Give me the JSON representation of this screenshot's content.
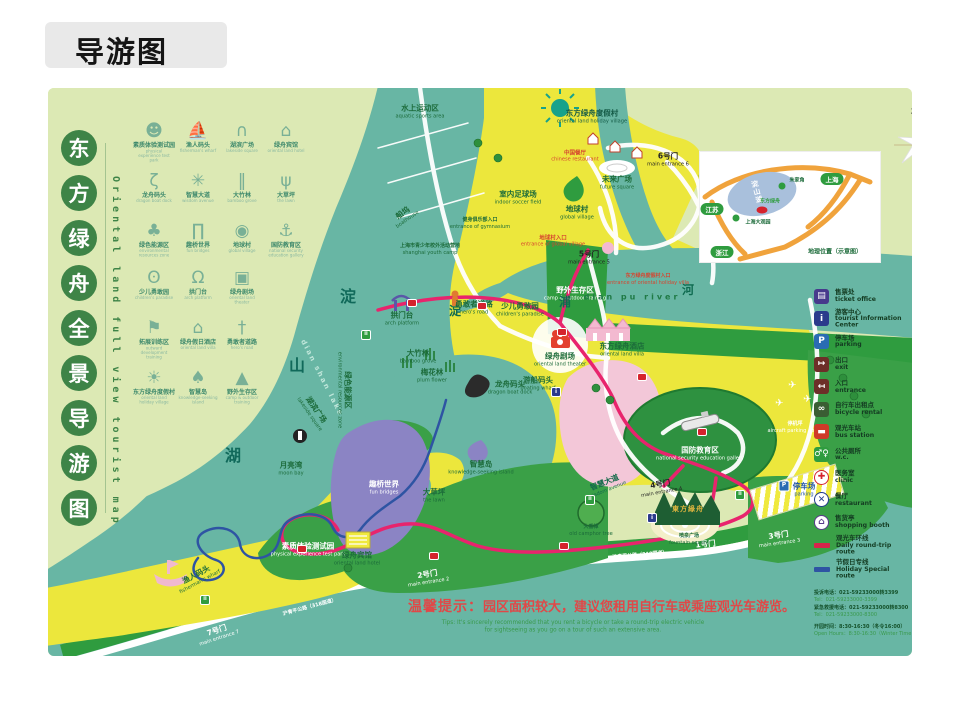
{
  "title": "导游图",
  "panel": {
    "chars": [
      "东",
      "方",
      "绿",
      "舟",
      "全",
      "景",
      "导",
      "游",
      "图"
    ],
    "vertical_en": "Oriental land full view tourist map"
  },
  "attractions_a": [
    {
      "zh": "素质体验测试园",
      "en": "physical experience test park",
      "glyph": "☻"
    },
    {
      "zh": "渔人码头",
      "en": "fisherman's wharf",
      "glyph": "⛵"
    },
    {
      "zh": "湖滨广场",
      "en": "lakeside square",
      "glyph": "∩"
    },
    {
      "zh": "绿舟宾馆",
      "en": "oriental land hotel",
      "glyph": "⌂"
    },
    {
      "zh": "龙舟码头",
      "en": "dragon boat dock",
      "glyph": "ζ"
    },
    {
      "zh": "智慧大道",
      "en": "wisdom avenue",
      "glyph": "✳"
    },
    {
      "zh": "大竹林",
      "en": "bamboo grove",
      "glyph": "‖"
    },
    {
      "zh": "大草坪",
      "en": "the lawn",
      "glyph": "ψ"
    },
    {
      "zh": "绿色能源区",
      "en": "environmental resources zone",
      "glyph": "♣"
    },
    {
      "zh": "趣桥世界",
      "en": "fun bridges",
      "glyph": "∏"
    },
    {
      "zh": "地球村",
      "en": "global village",
      "glyph": "◉"
    },
    {
      "zh": "国防教育区",
      "en": "national security education gallery",
      "glyph": "⚓"
    }
  ],
  "attractions_b": [
    {
      "zh": "少儿勇敢园",
      "en": "children's paradise",
      "glyph": "ʘ"
    },
    {
      "zh": "拱门台",
      "en": "arch platform",
      "glyph": "Ω"
    },
    {
      "zh": "绿舟剧场",
      "en": "oriental land theater",
      "glyph": "▣"
    },
    {
      "zh": "拓展训练区",
      "en": "outward development training",
      "glyph": "⚑"
    },
    {
      "zh": "绿舟假日酒店",
      "en": "oriental land villa",
      "glyph": "⌂"
    },
    {
      "zh": "勇敢者道路",
      "en": "hero's road",
      "glyph": "†"
    },
    {
      "zh": "东方绿舟度假村",
      "en": "oriental land holiday village",
      "glyph": "☀"
    },
    {
      "zh": "智慧岛",
      "en": "knowledge-seeking island",
      "glyph": "♠"
    },
    {
      "zh": "野外生存区",
      "en": "camp & outdoor training",
      "glyph": "▲"
    }
  ],
  "labels": {
    "aquatic": {
      "zh": "水上运动区",
      "en": "aquatic sports area"
    },
    "boathouse": {
      "zh": "船坞",
      "en": "boathouse"
    },
    "youth_camp": {
      "zh": "上海市青少年校外活动营地",
      "en": "shanghai youth camp"
    },
    "gym_entrance": {
      "zh": "健身俱乐部入口",
      "en": "entrance of gymnasium"
    },
    "soccer": {
      "zh": "室内足球场",
      "en": "indoor soccer field"
    },
    "holiday_village": {
      "zh": "东方绿舟度假村",
      "en": "oriental land holiday village"
    },
    "chinese_restaurant": {
      "zh": "中国餐厅",
      "en": "chinese restaurant"
    },
    "future_square": {
      "zh": "未来广场",
      "en": "future square"
    },
    "global_village": {
      "zh": "地球村",
      "en": "global village"
    },
    "gate6": {
      "zh": "6号门",
      "en": "main entrance 6"
    },
    "gv_entrance": {
      "zh": "地球村入口",
      "en": "entrance of global village"
    },
    "gate5": {
      "zh": "5号门",
      "en": "main entrance 5"
    },
    "camp": {
      "zh": "野外生存区",
      "en": "camp & outdoor training"
    },
    "hv_entrance": {
      "zh": "东方绿舟度假村入口",
      "en": "entrance of oriental holiday villa"
    },
    "river_en": {
      "zh": "dian pu river"
    },
    "river_dian": {
      "zh": "淀"
    },
    "river_pu": {
      "zh": "浦"
    },
    "river_he": {
      "zh": "河"
    },
    "lake_dian": {
      "zh": "淀"
    },
    "lake_shan": {
      "zh": "山"
    },
    "lake_hu": {
      "zh": "湖"
    },
    "lake_en": {
      "zh": "dian shan lake"
    },
    "villa": {
      "zh": "东方绿舟酒店",
      "en": "oriental land villa"
    },
    "theater": {
      "zh": "绿舟剧场",
      "en": "oriental land theater"
    },
    "wharf": {
      "zh": "游船码头",
      "en": "boating wharf"
    },
    "arch": {
      "zh": "拱门台",
      "en": "arch platform"
    },
    "hero": {
      "zh": "勇敢者道路",
      "en": "hero's road"
    },
    "children": {
      "zh": "少儿勇敢园",
      "en": "children's paradise"
    },
    "bamboo": {
      "zh": "大竹林",
      "en": "bamboo grove"
    },
    "plum": {
      "zh": "梅花林",
      "en": "plum flower"
    },
    "dragon": {
      "zh": "龙舟码头",
      "en": "dragon boat dock"
    },
    "energy": {
      "zh": "绿色能源区",
      "en": "environmental resources zone"
    },
    "bridges": {
      "zh": "趣桥世界",
      "en": "fun bridges"
    },
    "island": {
      "zh": "智慧岛",
      "en": "knowledge-seeking island"
    },
    "moonbay": {
      "zh": "月亮湾",
      "en": "moon bay"
    },
    "lakeside": {
      "zh": "湖滨广场",
      "en": "lakeside square"
    },
    "fisherman": {
      "zh": "渔人码头",
      "en": "fisherman's wharf"
    },
    "physical": {
      "zh": "素质体验测试园",
      "en": "physical experience test park"
    },
    "hotel": {
      "zh": "绿舟宾馆",
      "en": "oriental land hotel"
    },
    "gate7": {
      "zh": "7号门",
      "en": "main entrance 7"
    },
    "gate2": {
      "zh": "2号门",
      "en": "main entrance 2"
    },
    "road318": {
      "zh": "沪青平公路（318国道）"
    },
    "lawn": {
      "zh": "大草坪",
      "en": "the lawn"
    },
    "defense": {
      "zh": "国防教育区",
      "en": "national security education gallery"
    },
    "apron": {
      "zh": "停机坪",
      "en": "aircraft parking apron"
    },
    "wisdom": {
      "zh": "智慧大道",
      "en": "wisdom avenue"
    },
    "camphor": {
      "zh": "大香樟",
      "en": "old camphor tree"
    },
    "gate4": {
      "zh": "4号门",
      "en": "main entrance 4"
    },
    "gate1": {
      "zh": "1号门",
      "en": "main entrance 1"
    },
    "gate3": {
      "zh": "3号门",
      "en": "main entrance 3"
    },
    "parking_r": {
      "zh": "停车场",
      "en": "parking"
    },
    "fountain_sq": {
      "zh": "喷泉广场",
      "en": "fountain square"
    },
    "gate_cal": {
      "zh": "東方綠舟"
    }
  },
  "icons": {
    "plane": "✈",
    "sun": "☀"
  },
  "inset": {
    "shanghai": "上海",
    "jiangsu": "江苏",
    "zhejiang": "浙江",
    "zhujiajiao": "朱家角",
    "guanyuan": "上海大观园",
    "oriental": "东方绿舟",
    "lake": "淀山湖",
    "caption": "地理位置（示意图）"
  },
  "compass": {
    "zh": "北",
    "en": "N"
  },
  "legend": {
    "items": [
      {
        "zh": "售票处",
        "en": "ticket office",
        "glyph": "▤",
        "bg": "#473a8c",
        "fg": "#ffffff",
        "sh": "sq"
      },
      {
        "zh": "游客中心",
        "en": "tourist Information Center",
        "glyph": "i",
        "bg": "#2b3a8c",
        "fg": "#ffffff",
        "sh": "sq"
      },
      {
        "zh": "停车场",
        "en": "parking",
        "glyph": "P",
        "bg": "#2a6cb3",
        "fg": "#ffffff",
        "sh": "sq"
      },
      {
        "zh": "出口",
        "en": "exit",
        "glyph": "↦",
        "bg": "#6d2f28",
        "fg": "#ffffff",
        "sh": "sq"
      },
      {
        "zh": "入口",
        "en": "entrance",
        "glyph": "↤",
        "bg": "#6d2f28",
        "fg": "#ffffff",
        "sh": "sq"
      },
      {
        "zh": "自行车出租点",
        "en": "bicycle rental",
        "glyph": "∞",
        "bg": "#3a5e33",
        "fg": "#ffffff",
        "sh": "sq"
      },
      {
        "zh": "观光车站",
        "en": "bus station",
        "glyph": "▬",
        "bg": "#cf3a28",
        "fg": "#ffffff",
        "sh": "sq"
      },
      {
        "zh": "公共厕所",
        "en": "w.c.",
        "glyph": "♂♀",
        "bg": "#2f9c3f",
        "fg": "#ffffff",
        "sh": "sq"
      },
      {
        "zh": "医务室",
        "en": "clinic",
        "glyph": "✚",
        "bg": "#ffffff",
        "fg": "#d5232d",
        "bc": "#d5232d",
        "sh": "ci"
      },
      {
        "zh": "餐厅",
        "en": "restaurant",
        "glyph": "✕",
        "bg": "#ffffff",
        "fg": "#223a8c",
        "bc": "#223a8c",
        "sh": "ci"
      },
      {
        "zh": "售货亭",
        "en": "shopping booth",
        "glyph": "⌂",
        "bg": "#ffffff",
        "fg": "#5a3a8c",
        "bc": "#5a3a8c",
        "sh": "ci"
      }
    ],
    "routes": [
      {
        "zh": "观光车环线",
        "en": "Daily round-trip route",
        "color": "#d7254b"
      },
      {
        "zh": "节假日专线",
        "en": "Holiday Special route",
        "color": "#2e54a3"
      }
    ]
  },
  "contact": {
    "l1": "投诉电话：021-59233000转3399",
    "l2": "Tel：021-59233000-3399",
    "l3": "紧急救援电话：021-59233000转8300",
    "l4": "Tel：021-59233000-8300",
    "l5": "开园时间：8:30-16:30（冬令16:00）",
    "l6": "Open Hours：8:30-16:30（Winter Time 16:00）"
  },
  "tips": {
    "lead": "温馨提示：",
    "zh": "园区面积较大，建议您租用自行车或乘座观光车游览。",
    "en1": "Tips: It's sincerely recommended that you rent a bicycle or take a round-trip electric vehicle",
    "en2": "for sightseeing as you go on a tour of such an extensive area."
  }
}
